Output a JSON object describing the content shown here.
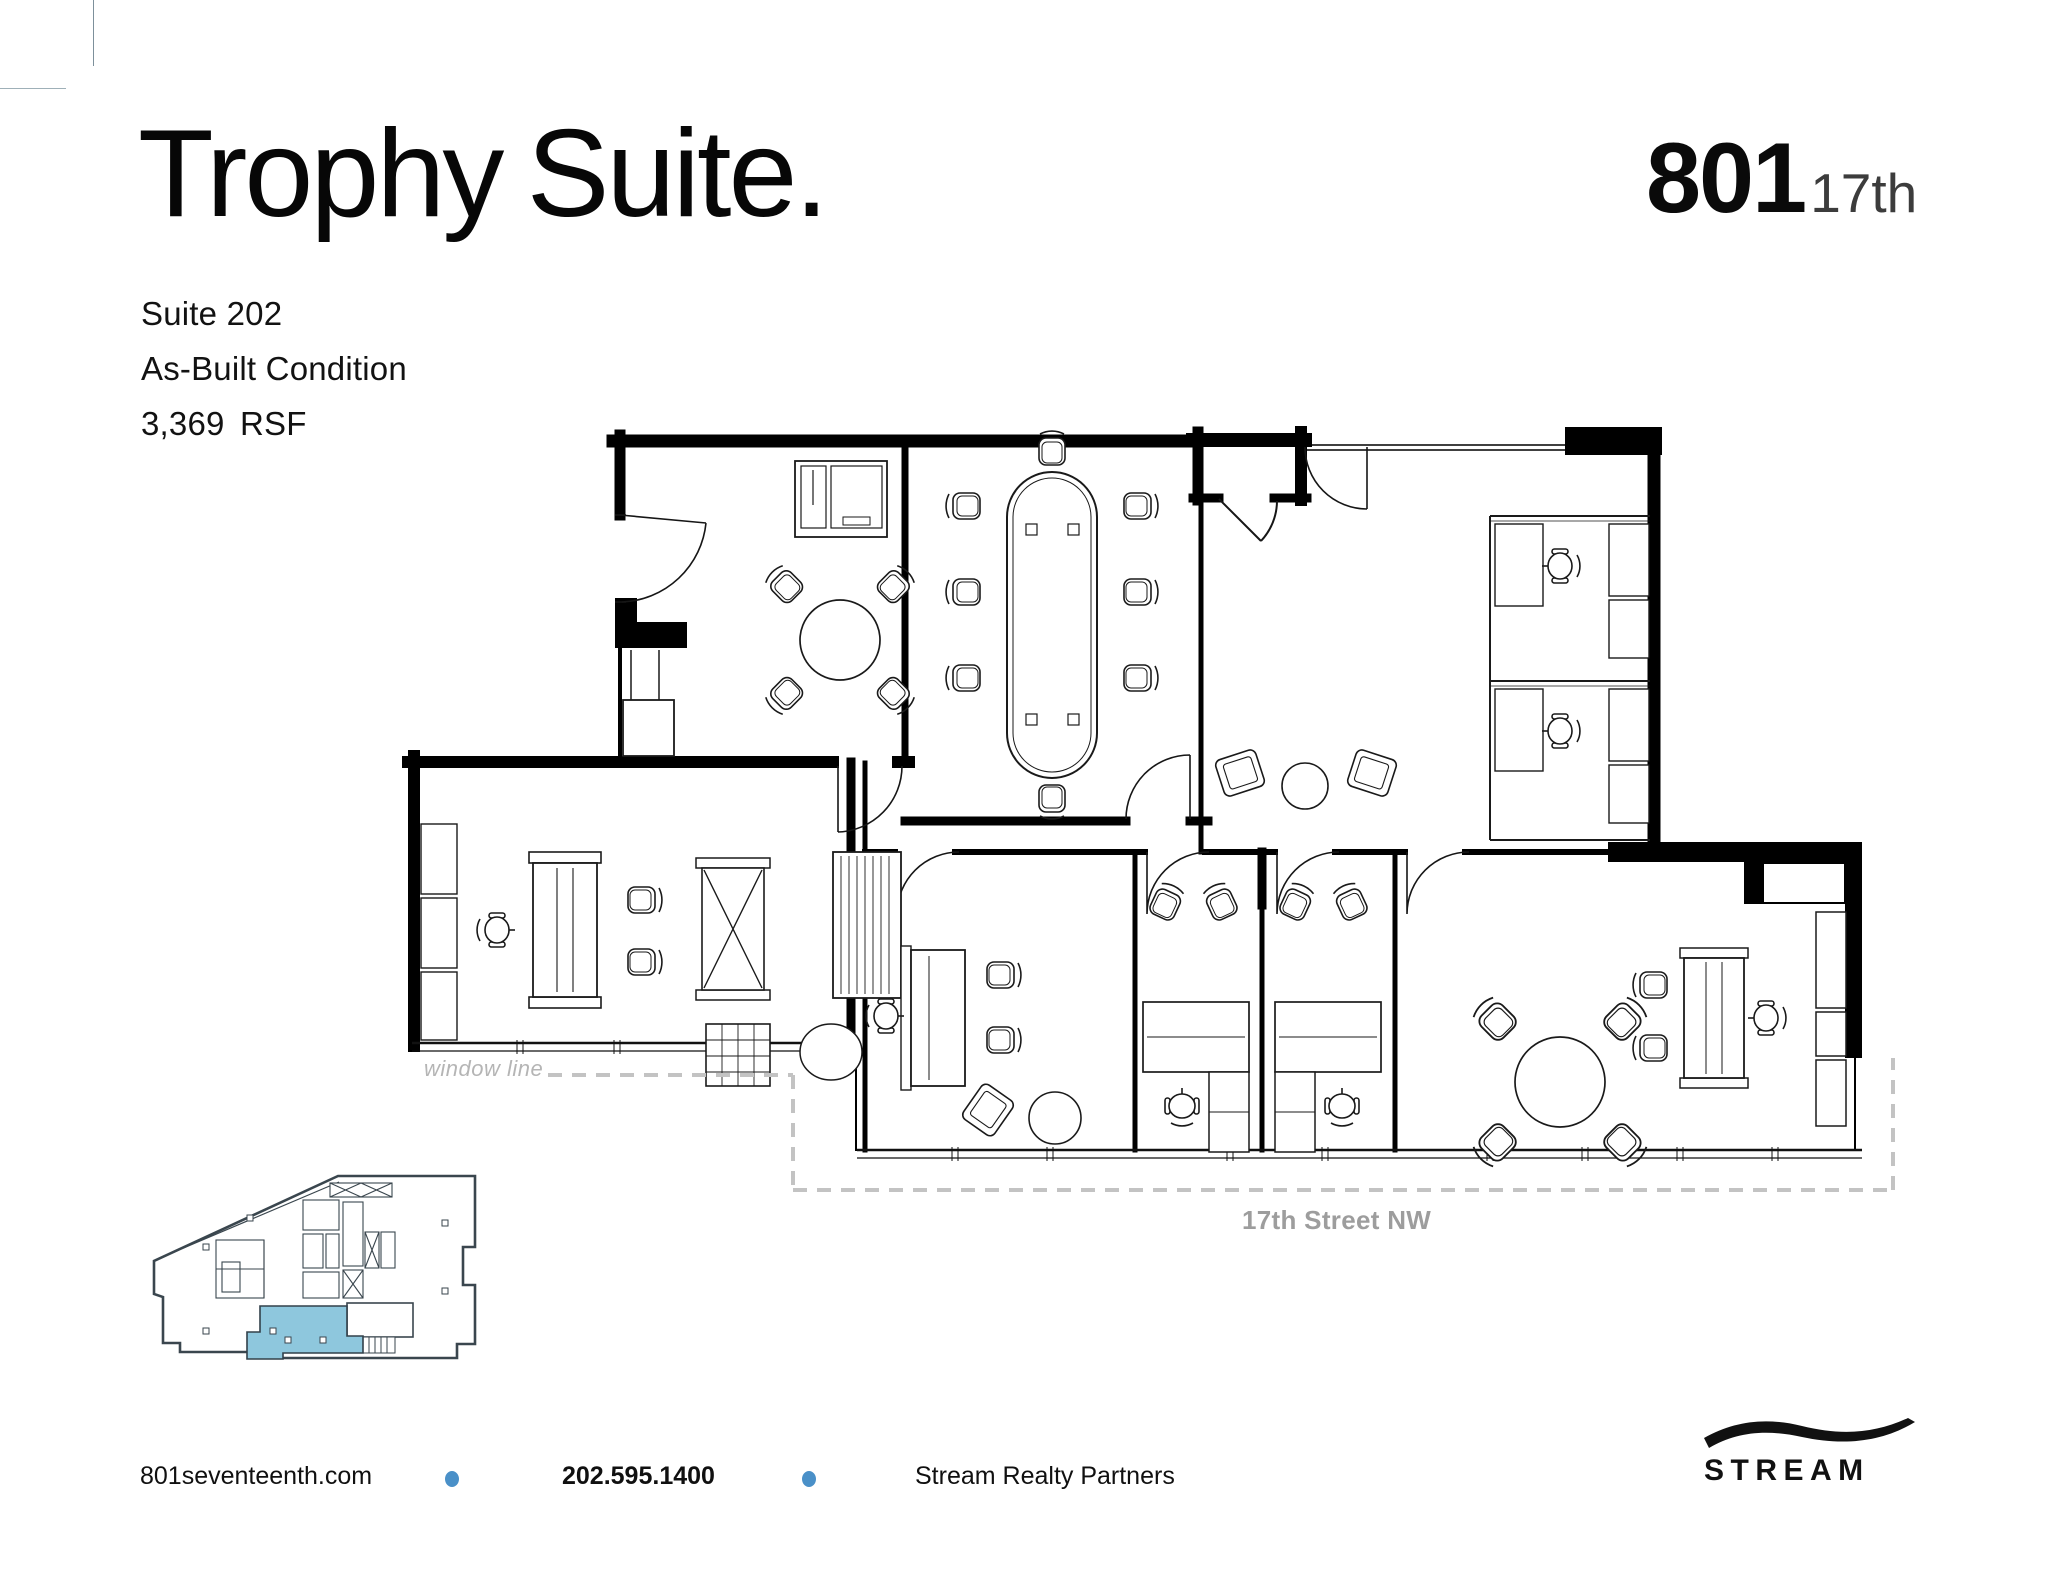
{
  "header": {
    "title": "Trophy Suite.",
    "suite_label": "Suite 202",
    "condition_label": "As-Built Condition",
    "area_label": "3,369 RSF"
  },
  "building_logo": {
    "number": "801",
    "street": "17th"
  },
  "plan_labels": {
    "window_line": "window line",
    "street": "17th Street NW"
  },
  "key_plan": {
    "suite_fill": "#8ec7dd"
  },
  "footer": {
    "website": "801seventeenth.com",
    "phone": "202.595.1400",
    "company": "Stream Realty Partners",
    "separator_color": "#4a90c8"
  },
  "brand": {
    "wordmark": "STREAM"
  }
}
